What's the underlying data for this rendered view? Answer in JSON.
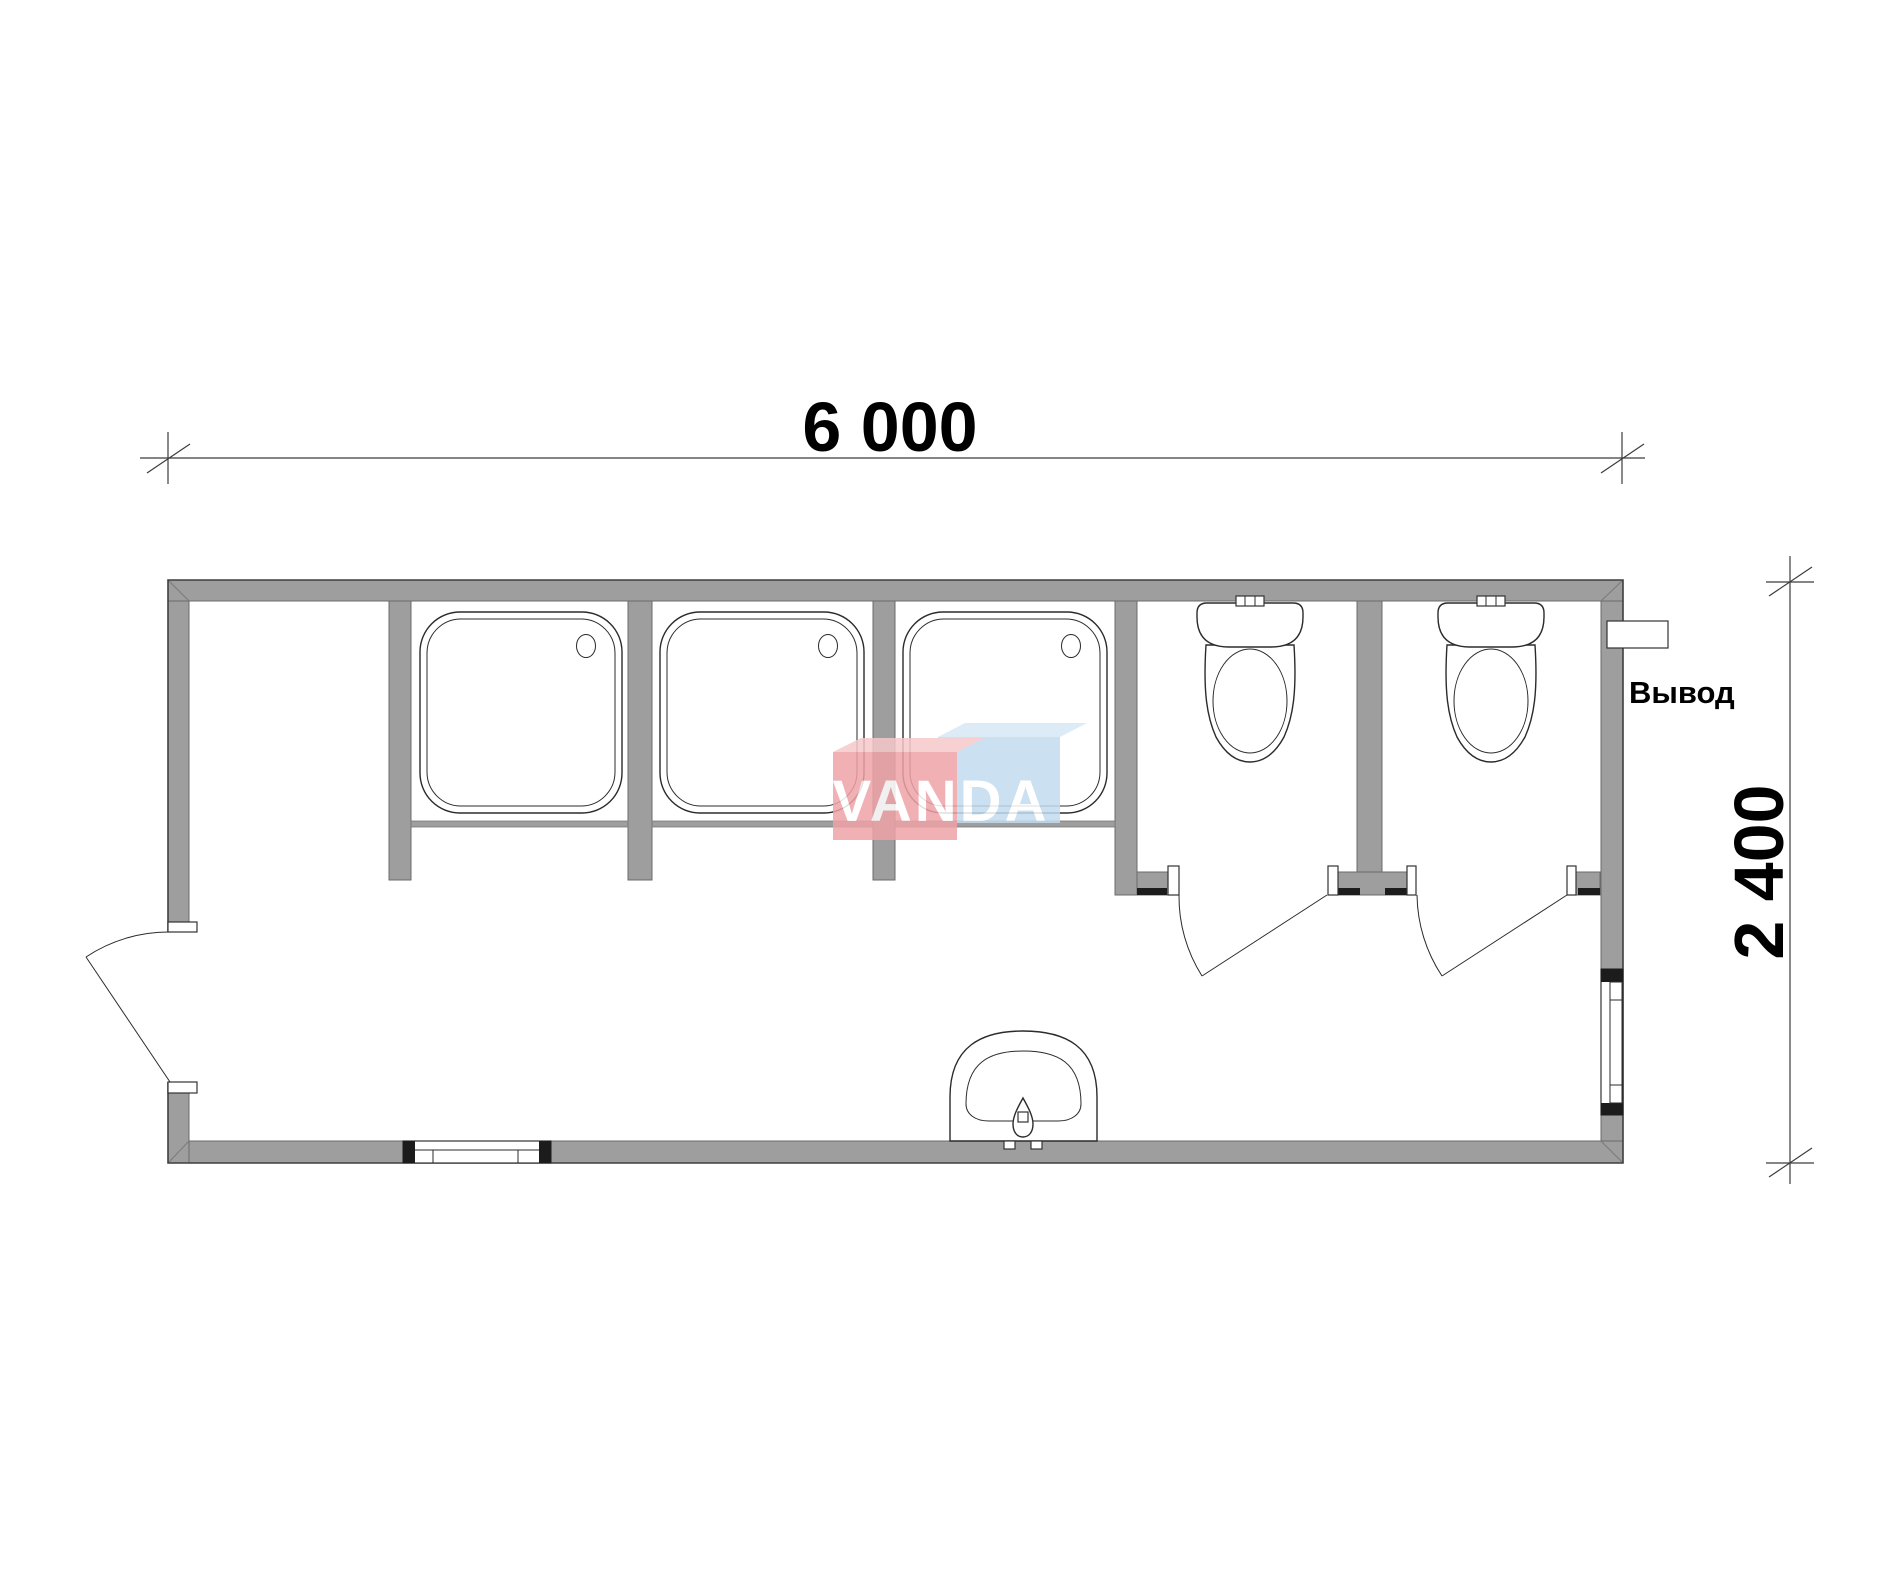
{
  "colors": {
    "background": "#ffffff",
    "wall_fill": "#9e9e9e",
    "wall_edge": "#6b6b6b",
    "outline": "#3f3f3f",
    "fixture_line": "#2b2b2b",
    "dim_line": "#3c3c3c",
    "text_color": "#000000",
    "wm_pink": "#efa3a7",
    "wm_pink_top": "#f6c8ca",
    "wm_blue": "#c2dbee",
    "wm_blue_top": "#d8e8f5",
    "wm_text": "#ffffff"
  },
  "dimensions": {
    "width_label": "6 000",
    "height_label": "2 400"
  },
  "annotations": {
    "outlet_label": "Вывод"
  },
  "watermark": {
    "text": "VANDA"
  },
  "plan": {
    "fixtures": {
      "shower_trays": 3,
      "toilets": 2,
      "washbasins": 1,
      "swing_doors": 3,
      "windows": 2
    }
  }
}
